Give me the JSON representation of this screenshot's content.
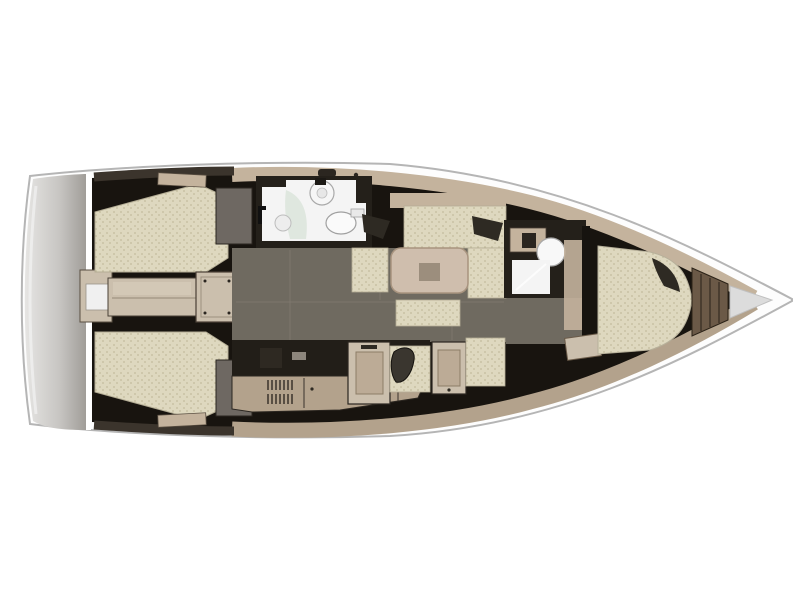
{
  "diagram": {
    "type": "yacht-interior-floor-plan",
    "orientation": {
      "bow": "right",
      "stern": "left",
      "port_side": "top",
      "starboard_side": "bottom"
    },
    "areas": [
      {
        "id": "swim-platform",
        "label": "transom swim platform"
      },
      {
        "id": "aft-cabin-port",
        "label": "aft double cabin (port)"
      },
      {
        "id": "aft-cabin-starboard",
        "label": "aft double cabin (starboard)"
      },
      {
        "id": "companionway",
        "label": "companionway steps"
      },
      {
        "id": "aft-head",
        "label": "aft head with shower, basin and toilet"
      },
      {
        "id": "salon-dinette",
        "label": "salon settee with table"
      },
      {
        "id": "galley",
        "label": "galley"
      },
      {
        "id": "nav-station",
        "label": "chart table with seat"
      },
      {
        "id": "forward-head",
        "label": "forward head"
      },
      {
        "id": "forward-cabin",
        "label": "forward double cabin"
      },
      {
        "id": "anchor-locker",
        "label": "anchor locker"
      },
      {
        "id": "bow",
        "label": "bow"
      }
    ]
  },
  "colors": {
    "background": "#ffffff",
    "hull_stroke": "#b5b5b5",
    "hull_white": "#fdfdfd",
    "interior_dark": "#18140f",
    "transom_light": "#e6e5e3",
    "transom_dark": "#9d9a95",
    "deck_tan": "#c4b39d",
    "deck_tan_dark": "#b3a28c",
    "stern_wall": "#3b342c",
    "mattress": "#ded8bf",
    "mattress_speckle": "#c3bb9d",
    "wood_light": "#cbbfad",
    "wood_mid": "#b5a48e",
    "wood_dark": "#6b5947",
    "floor_gray": "#6f6a60",
    "table": "#cfbead",
    "table_inlay": "#9c8e7d",
    "white_room": "#f4f4f4",
    "shower_glass": "#d9e4d9",
    "cabinet_gray": "#6e6862",
    "pillow_dark": "#2e2a23",
    "counter_dark": "#221e18",
    "bow_wedge": "#dcdcdc"
  }
}
